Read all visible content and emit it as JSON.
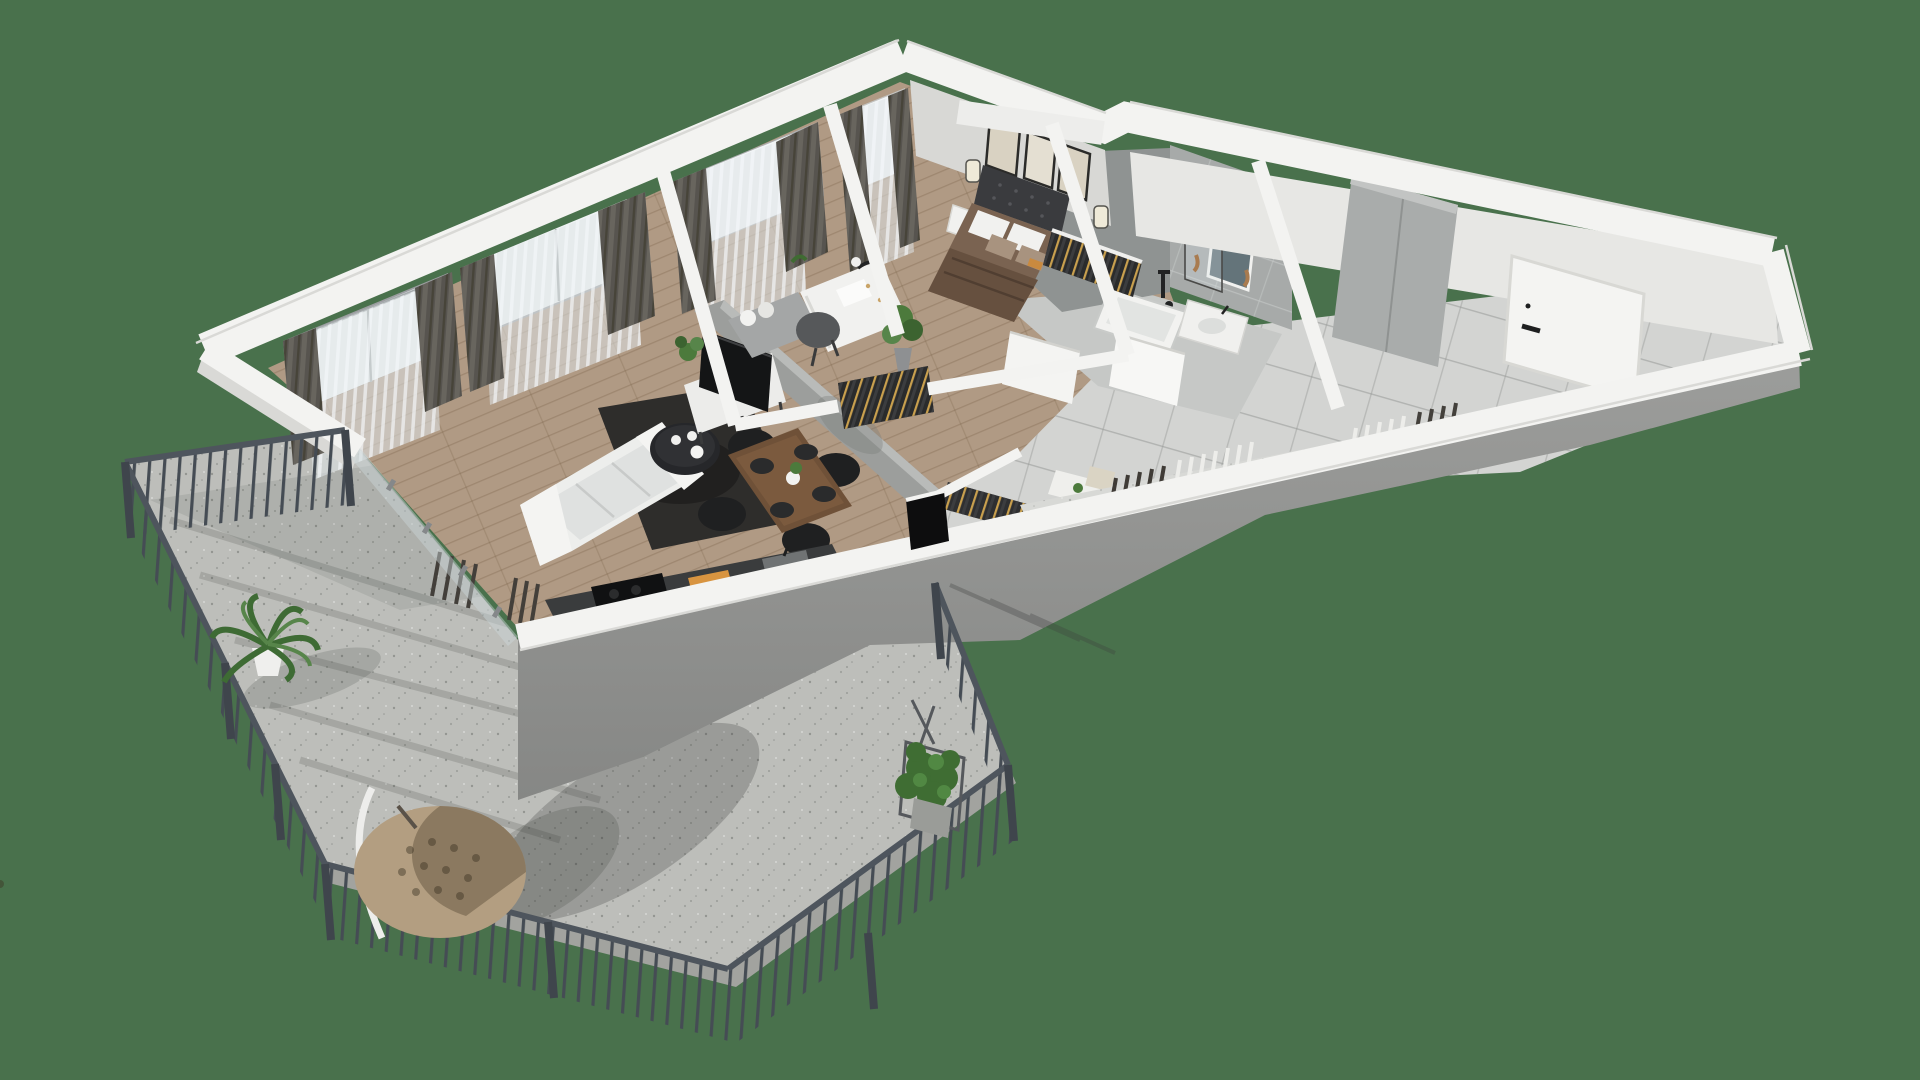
{
  "scene": {
    "title": "3D isometric floor plan render of a one-bedroom apartment with wrap-around balcony",
    "rooms": [
      "living-room",
      "dining-area",
      "kitchen",
      "study",
      "bedroom",
      "bathroom",
      "hallway",
      "balcony-terrace"
    ],
    "objects": [
      "sofa",
      "rug",
      "coffee-table",
      "tv",
      "tv-console",
      "dining-table",
      "dining-chairs",
      "place-mats",
      "kitchen-counter",
      "cooktop",
      "cutting-board",
      "kitchen-sink",
      "bed",
      "tufted-headboard",
      "pillows",
      "nightstand",
      "wall-art-frames",
      "wall-sconces",
      "desk",
      "desk-chair",
      "daybed",
      "desk-lamp",
      "potted-plants",
      "wardrobe-clothes-rails",
      "bathtub",
      "shower-glass",
      "shower-fixture",
      "vanity-sink",
      "bathroom-mirror",
      "hall-wardrobe",
      "entrance-door",
      "interior-doors",
      "radiators",
      "curtains",
      "sheer-curtains",
      "windows",
      "sliding-balcony-door",
      "balcony-railing",
      "hanging-egg-chair",
      "palm-plant",
      "ivy-planter",
      "concrete-terrace-floor",
      "wood-floor",
      "tile-floor"
    ]
  },
  "colors": {
    "background": "#49714C",
    "wall_top": "#F3F3F1",
    "wall_edge": "#DDDDDA",
    "wall_face": "#909290",
    "wall_inner": "#9B9DA0",
    "wood_floor": "#B09A84",
    "tile_floor": "#D3D4D2",
    "bath_tile": "#A7AAA9",
    "concrete": "#BDBEBA",
    "railing": "#4A5158",
    "curtain": "#57544F",
    "sheer": "#C9CDD0",
    "rug": "#2E2D2B",
    "sofa": "#EDEEEC",
    "dining_table": "#6F5138",
    "bedding": "#7A6351",
    "tv": "#141516",
    "counter": "#3A3C3D",
    "plant": "#4C7A3C",
    "egg_chair": "#B39E81",
    "door": "#F4F4F2"
  }
}
